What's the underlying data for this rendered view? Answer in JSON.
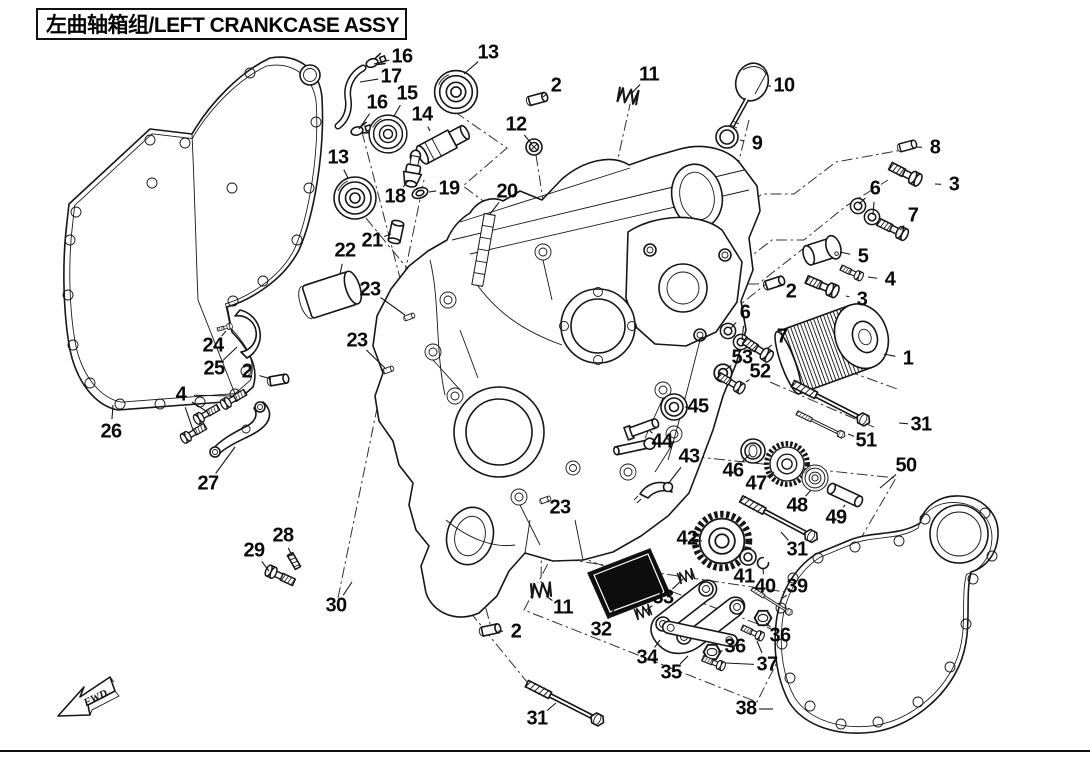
{
  "title": {
    "zh": "左曲轴箱组",
    "en": "LEFT CRANKCASE ASSY",
    "full": "左曲轴箱组/LEFT CRANKCASE ASSY"
  },
  "fwd_marker": "FWD",
  "colors": {
    "ink": "#161616",
    "background": "#ffffff",
    "strainer_fill": "#0d0d0d"
  },
  "callouts": [
    {
      "n": "16",
      "x": 402,
      "y": 57,
      "t": [
        [
          374,
          64
        ]
      ]
    },
    {
      "n": "17",
      "x": 391,
      "y": 77,
      "t": [
        [
          360,
          82
        ]
      ]
    },
    {
      "n": "13",
      "x": 488,
      "y": 53,
      "t": [
        [
          464,
          74
        ]
      ]
    },
    {
      "n": "2",
      "x": 556,
      "y": 86,
      "t": [
        [
          543,
          97
        ]
      ]
    },
    {
      "n": "11",
      "x": 649,
      "y": 75,
      "t": [
        [
          632,
          93
        ]
      ]
    },
    {
      "n": "10",
      "x": 784,
      "y": 86,
      "t": [
        [
          768,
          86
        ]
      ]
    },
    {
      "n": "15",
      "x": 407,
      "y": 94,
      "t": [
        [
          394,
          116
        ]
      ]
    },
    {
      "n": "16",
      "x": 377,
      "y": 103,
      "t": [
        [
          359,
          129
        ]
      ]
    },
    {
      "n": "14",
      "x": 422,
      "y": 115,
      "t": [
        [
          430,
          131
        ]
      ]
    },
    {
      "n": "12",
      "x": 516,
      "y": 125,
      "t": [
        [
          531,
          143
        ]
      ]
    },
    {
      "n": "9",
      "x": 757,
      "y": 144,
      "t": [
        [
          740,
          140
        ]
      ]
    },
    {
      "n": "8",
      "x": 935,
      "y": 148,
      "t": [
        [
          916,
          147
        ]
      ]
    },
    {
      "n": "13",
      "x": 338,
      "y": 158,
      "t": [
        [
          348,
          178
        ]
      ]
    },
    {
      "n": "3",
      "x": 954,
      "y": 185,
      "t": [
        [
          935,
          184
        ]
      ]
    },
    {
      "n": "6",
      "x": 875,
      "y": 189,
      "t": [
        [
          859,
          204
        ],
        [
          873,
          215
        ]
      ]
    },
    {
      "n": "18",
      "x": 395,
      "y": 197,
      "t": [
        [
          408,
          181
        ]
      ]
    },
    {
      "n": "19",
      "x": 449,
      "y": 189,
      "t": [
        [
          429,
          192
        ]
      ]
    },
    {
      "n": "20",
      "x": 507,
      "y": 192,
      "t": [
        [
          490,
          214
        ]
      ]
    },
    {
      "n": "7",
      "x": 913,
      "y": 216,
      "t": [
        [
          900,
          230
        ]
      ]
    },
    {
      "n": "21",
      "x": 372,
      "y": 241,
      "t": [
        [
          391,
          234
        ]
      ]
    },
    {
      "n": "5",
      "x": 863,
      "y": 257,
      "t": [
        [
          840,
          252
        ]
      ]
    },
    {
      "n": "22",
      "x": 345,
      "y": 251,
      "t": [
        [
          340,
          274
        ]
      ]
    },
    {
      "n": "4",
      "x": 890,
      "y": 280,
      "t": [
        [
          868,
          277
        ]
      ]
    },
    {
      "n": "2",
      "x": 791,
      "y": 292,
      "t": [
        [
          778,
          285
        ]
      ]
    },
    {
      "n": "23",
      "x": 370,
      "y": 290,
      "t": [
        [
          405,
          315
        ]
      ]
    },
    {
      "n": "3",
      "x": 862,
      "y": 300,
      "t": [
        [
          846,
          296
        ]
      ]
    },
    {
      "n": "6",
      "x": 745,
      "y": 313,
      "t": [
        [
          730,
          329
        ],
        [
          742,
          340
        ]
      ]
    },
    {
      "n": "7",
      "x": 782,
      "y": 337,
      "t": [
        [
          768,
          348
        ]
      ]
    },
    {
      "n": "1",
      "x": 908,
      "y": 359,
      "t": [
        [
          884,
          354
        ]
      ]
    },
    {
      "n": "53",
      "x": 742,
      "y": 358,
      "t": [
        [
          725,
          370
        ]
      ]
    },
    {
      "n": "23",
      "x": 357,
      "y": 341,
      "t": [
        [
          385,
          368
        ]
      ]
    },
    {
      "n": "52",
      "x": 760,
      "y": 372,
      "t": [
        [
          746,
          382
        ]
      ]
    },
    {
      "n": "24",
      "x": 213,
      "y": 346,
      "t": [
        [
          226,
          331
        ]
      ]
    },
    {
      "n": "25",
      "x": 214,
      "y": 369,
      "t": [
        [
          237,
          347
        ]
      ]
    },
    {
      "n": "2",
      "x": 247,
      "y": 372,
      "t": [
        [
          271,
          379
        ]
      ]
    },
    {
      "n": "45",
      "x": 698,
      "y": 407,
      "t": [
        [
          688,
          407
        ]
      ]
    },
    {
      "n": "31",
      "x": 921,
      "y": 425,
      "t": [
        [
          899,
          423
        ]
      ]
    },
    {
      "n": "4",
      "x": 181,
      "y": 395,
      "t": [
        [
          233,
          396
        ],
        [
          206,
          411
        ],
        [
          193,
          430
        ]
      ]
    },
    {
      "n": "51",
      "x": 866,
      "y": 441,
      "t": [
        [
          848,
          434
        ]
      ]
    },
    {
      "n": "44",
      "x": 662,
      "y": 442,
      "t": [
        [
          650,
          431
        ]
      ]
    },
    {
      "n": "26",
      "x": 111,
      "y": 432,
      "t": [
        [
          113,
          405
        ]
      ]
    },
    {
      "n": "46",
      "x": 733,
      "y": 471,
      "t": [
        [
          750,
          454
        ]
      ]
    },
    {
      "n": "27",
      "x": 208,
      "y": 484,
      "t": [
        [
          235,
          447
        ]
      ]
    },
    {
      "n": "43",
      "x": 689,
      "y": 457,
      "t": [
        [
          668,
          484
        ]
      ]
    },
    {
      "n": "47",
      "x": 756,
      "y": 484,
      "t": [
        [
          774,
          472
        ]
      ]
    },
    {
      "n": "50",
      "x": 906,
      "y": 466,
      "t": [
        [
          880,
          488
        ]
      ]
    },
    {
      "n": "48",
      "x": 797,
      "y": 506,
      "t": [
        [
          811,
          490
        ]
      ]
    },
    {
      "n": "49",
      "x": 836,
      "y": 518,
      "t": [
        [
          845,
          505
        ]
      ]
    },
    {
      "n": "42",
      "x": 687,
      "y": 539,
      "t": [
        [
          702,
          541
        ]
      ]
    },
    {
      "n": "23",
      "x": 560,
      "y": 508,
      "t": [
        [
          547,
          501
        ]
      ]
    },
    {
      "n": "31",
      "x": 797,
      "y": 550,
      "t": [
        [
          781,
          532
        ]
      ]
    },
    {
      "n": "28",
      "x": 283,
      "y": 536,
      "t": [
        [
          292,
          556
        ]
      ]
    },
    {
      "n": "29",
      "x": 254,
      "y": 551,
      "t": [
        [
          269,
          571
        ]
      ]
    },
    {
      "n": "41",
      "x": 744,
      "y": 577,
      "t": [
        [
          748,
          564
        ]
      ]
    },
    {
      "n": "40",
      "x": 765,
      "y": 587,
      "t": [
        [
          763,
          569
        ]
      ]
    },
    {
      "n": "39",
      "x": 797,
      "y": 587,
      "t": [
        [
          783,
          598
        ]
      ]
    },
    {
      "n": "30",
      "x": 336,
      "y": 606,
      "t": [
        [
          352,
          582
        ]
      ]
    },
    {
      "n": "11",
      "x": 563,
      "y": 608,
      "t": [
        [
          546,
          596
        ]
      ]
    },
    {
      "n": "33",
      "x": 663,
      "y": 598,
      "t": [
        [
          683,
          579
        ],
        [
          645,
          611
        ]
      ]
    },
    {
      "n": "32",
      "x": 601,
      "y": 630,
      "t": [
        [
          618,
          603
        ]
      ]
    },
    {
      "n": "2",
      "x": 516,
      "y": 632,
      "t": [
        [
          498,
          631
        ]
      ]
    },
    {
      "n": "36",
      "x": 780,
      "y": 636,
      "t": [
        [
          766,
          623
        ]
      ]
    },
    {
      "n": "34",
      "x": 647,
      "y": 658,
      "t": [
        [
          660,
          640
        ]
      ]
    },
    {
      "n": "36",
      "x": 735,
      "y": 647,
      "t": [
        [
          718,
          652
        ]
      ]
    },
    {
      "n": "35",
      "x": 671,
      "y": 673,
      "t": [
        [
          688,
          656
        ]
      ]
    },
    {
      "n": "37",
      "x": 767,
      "y": 665,
      "t": [
        [
          757,
          641
        ],
        [
          726,
          663
        ]
      ]
    },
    {
      "n": "38",
      "x": 746,
      "y": 709,
      "t": [
        [
          773,
          709
        ]
      ]
    },
    {
      "n": "31",
      "x": 537,
      "y": 719,
      "t": [
        [
          556,
          703
        ]
      ]
    }
  ]
}
